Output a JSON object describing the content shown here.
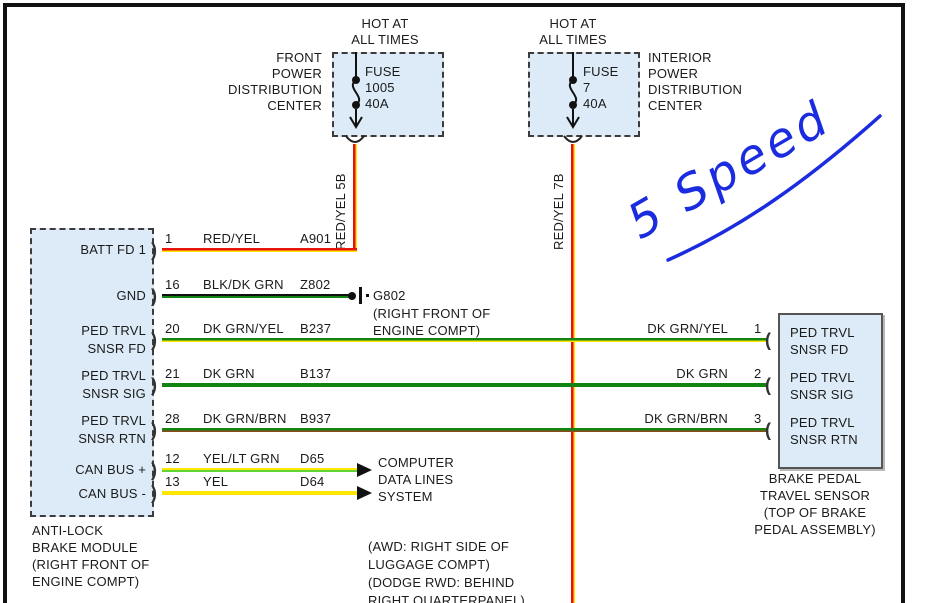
{
  "fuse_left": {
    "hot_lines": [
      "HOT AT",
      "ALL TIMES"
    ],
    "name_lines": [
      "FRONT",
      "POWER",
      "DISTRIBUTION",
      "CENTER"
    ],
    "fuse_lines": [
      "FUSE",
      "1005",
      "40A"
    ],
    "wire_label": "RED/YEL  5B"
  },
  "fuse_right": {
    "hot_lines": [
      "HOT AT",
      "ALL TIMES"
    ],
    "name_lines": [
      "INTERIOR",
      "POWER",
      "DISTRIBUTION",
      "CENTER"
    ],
    "fuse_lines": [
      "FUSE",
      "7",
      "40A"
    ],
    "wire_label": "RED/YEL  7B"
  },
  "module": {
    "caption_lines": [
      "ANTI-LOCK",
      "BRAKE MODULE",
      "(RIGHT FRONT OF",
      "ENGINE COMPT)"
    ],
    "pins": [
      {
        "pin": "1",
        "name_lines": [
          "BATT FD 1"
        ],
        "wire": "RED/YEL",
        "circuit": "A901"
      },
      {
        "pin": "16",
        "name_lines": [
          "GND"
        ],
        "wire": "BLK/DK GRN",
        "circuit": "Z802"
      },
      {
        "pin": "20",
        "name_lines": [
          "PED TRVL",
          "SNSR FD"
        ],
        "wire": "DK GRN/YEL",
        "circuit": "B237"
      },
      {
        "pin": "21",
        "name_lines": [
          "PED TRVL",
          "SNSR SIG"
        ],
        "wire": "DK GRN",
        "circuit": "B137"
      },
      {
        "pin": "28",
        "name_lines": [
          "PED TRVL",
          "SNSR RTN"
        ],
        "wire": "DK GRN/BRN",
        "circuit": "B937"
      },
      {
        "pin": "12",
        "name_lines": [
          "CAN BUS +"
        ],
        "wire": "YEL/LT GRN",
        "circuit": "D65"
      },
      {
        "pin": "13",
        "name_lines": [
          "CAN BUS -"
        ],
        "wire": "YEL",
        "circuit": "D64"
      }
    ]
  },
  "ground": {
    "label": "G802",
    "location_lines": [
      "(RIGHT FRONT OF",
      "ENGINE COMPT)"
    ]
  },
  "computer_note_lines": [
    "COMPUTER",
    "DATA LINES",
    "SYSTEM"
  ],
  "awd_note_lines": [
    "(AWD: RIGHT SIDE OF",
    "LUGGAGE COMPT)",
    "(DODGE RWD: BEHIND",
    "RIGHT QUARTERPANEL)"
  ],
  "sensor": {
    "caption_lines": [
      "BRAKE PEDAL",
      "TRAVEL SENSOR",
      "(TOP OF BRAKE",
      "PEDAL ASSEMBLY)"
    ],
    "pins": [
      {
        "pin": "1",
        "wire": "DK GRN/YEL",
        "name_lines": [
          "PED TRVL",
          "SNSR FD"
        ]
      },
      {
        "pin": "2",
        "wire": "DK GRN",
        "name_lines": [
          "PED TRVL",
          "SNSR SIG"
        ]
      },
      {
        "pin": "3",
        "wire": "DK GRN/BRN",
        "name_lines": [
          "PED TRVL",
          "SNSR RTN"
        ]
      }
    ]
  },
  "annotation": {
    "text": "5 Speed",
    "color": "#1b2ce0"
  },
  "colors": {
    "red": "#e8130c",
    "yellow": "#ffe600",
    "dk_grn": "#118411",
    "black": "#111111",
    "brown": "#8a4a1e",
    "lt_grn": "#5fd435",
    "box_fill": "#dcebf7",
    "annotation_blue": "#1b2ce0"
  }
}
